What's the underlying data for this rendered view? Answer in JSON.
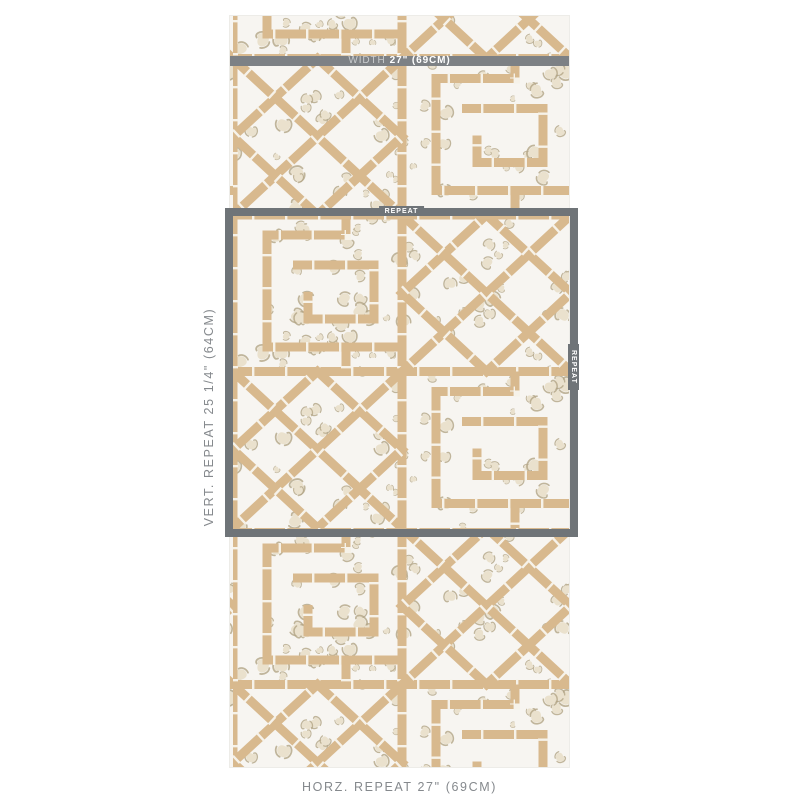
{
  "swatch": {
    "kind": "wallpaper-pattern-preview",
    "description": "Bamboo trellis chinoiserie wallpaper with leopard-spot ground"
  },
  "annotations": {
    "width_bar": {
      "prefix": "WIDTH",
      "value": "27\" (69CM)"
    },
    "repeat_box": {
      "top_tag": "REPEAT",
      "right_tag": "REPEAT"
    },
    "vertical_repeat": "VERT. REPEAT 25 1/4\" (64CM)",
    "horizontal_repeat": "HORZ. REPEAT 27\" (69CM)"
  },
  "colors": {
    "annotation-gray": "#6f7478",
    "bar-gray": "#7d8185",
    "label-text": "#85898d",
    "bar-prefix-text": "#c9ccce",
    "bar-value-text": "#ffffff",
    "swatch-bg": "#f7f5f1",
    "bamboo": "#d8b98e",
    "bamboo-node": "#f6f2e9",
    "spot-fill": "#eae1cd",
    "spot-line": "#b3a586"
  }
}
